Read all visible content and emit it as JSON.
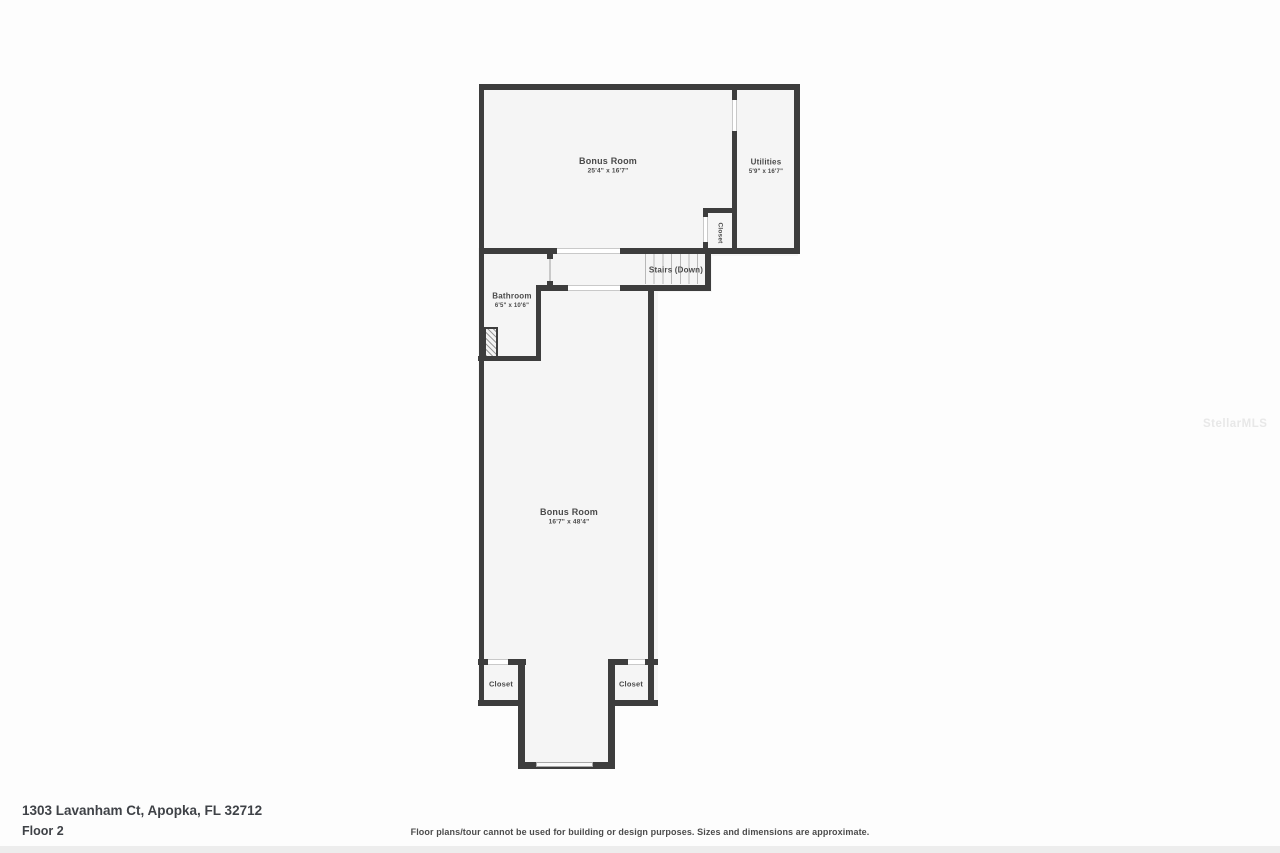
{
  "colors": {
    "wall": "#3d3d3d",
    "room_fill": "#f5f5f5",
    "opening_line": "#c9c9c9",
    "stair_tread_line": "#b8b8b8",
    "label_text": "#4a4a4a",
    "footer_text": "#3f4247",
    "watermark_text": "#e8e8e8"
  },
  "rooms": {
    "bonus_top": {
      "name": "Bonus Room",
      "dims": "25'4\" x 16'7\""
    },
    "utilities": {
      "name": "Utilities",
      "dims": "5'9\" x 16'7\""
    },
    "closet_top": {
      "name": "Closet"
    },
    "stairs": {
      "name": "Stairs (Down)"
    },
    "bathroom": {
      "name": "Bathroom",
      "dims": "6'5\" x 10'6\""
    },
    "bonus_bottom": {
      "name": "Bonus Room",
      "dims": "16'7\" x 48'4\""
    },
    "closet_left": {
      "name": "Closet"
    },
    "closet_right": {
      "name": "Closet"
    }
  },
  "footer": {
    "address": "1303 Lavanham Ct, Apopka, FL 32712",
    "floor": "Floor 2",
    "disclaimer": "Floor plans/tour cannot be used for building or design purposes. Sizes and dimensions are approximate."
  },
  "watermark": "StellarMLS"
}
